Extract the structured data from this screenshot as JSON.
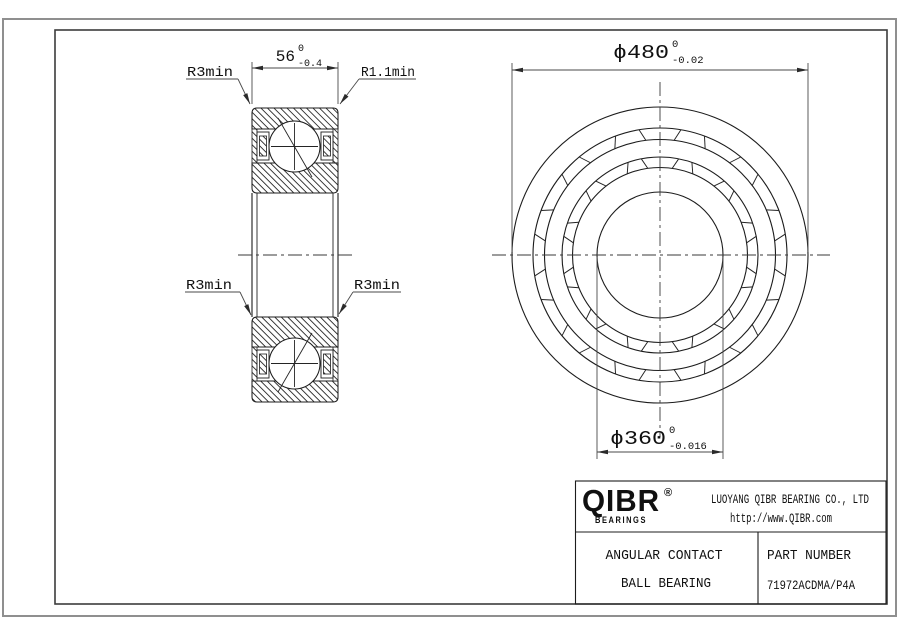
{
  "drawing": {
    "section_view": {
      "width_dim": {
        "value": "56",
        "upper_tol": "0",
        "lower_tol": "-0.4"
      },
      "labels": {
        "r3_top_left": "R3min",
        "r1_top_right": "R1.1min",
        "r3_mid_left": "R3min",
        "r3_mid_right": "R3min"
      }
    },
    "front_view": {
      "od_dim": {
        "value": "ϕ480",
        "upper_tol": "0",
        "lower_tol": "-0.02"
      },
      "bore_dim": {
        "value": "ϕ360",
        "upper_tol": "0",
        "lower_tol": "-0.016"
      }
    },
    "title_block": {
      "logo": {
        "name": "QIBR",
        "reg": "®",
        "sub": "BEARINGS"
      },
      "company": "LUOYANG QIBR BEARING CO., LTD",
      "website": "http://www.QIBR.com",
      "product_line1": "ANGULAR CONTACT",
      "product_line2": "BALL BEARING",
      "part_label": "PART NUMBER",
      "part_number": "71972ACDMA/P4A"
    },
    "colors": {
      "line": "#1c1c1c",
      "border_outer": "#8f8f8f",
      "paper": "#ffffff"
    }
  }
}
